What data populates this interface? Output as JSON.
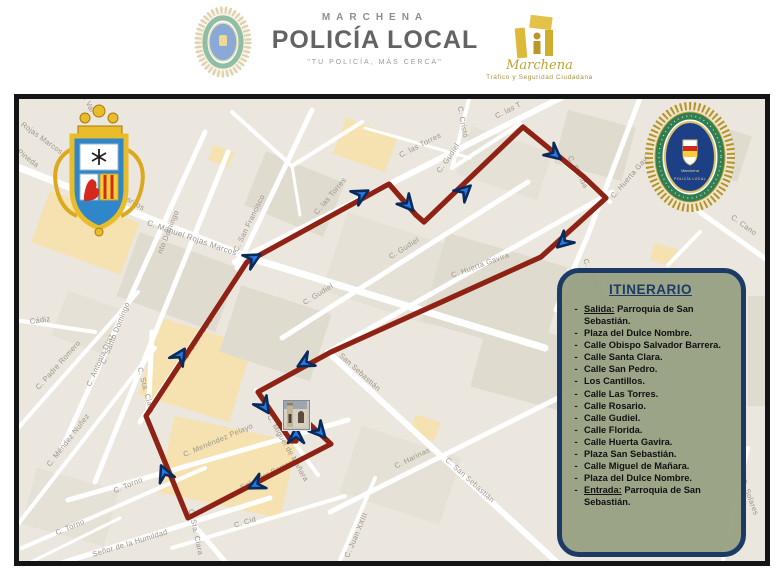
{
  "header": {
    "brand_top": "MARCHENA",
    "brand_main": "POLICÍA LOCAL",
    "brand_tagline": "\"TU POLICÍA, MÁS CERCA\"",
    "right_logo_script": "Marchena",
    "right_logo_sub": "Tráfico y Seguridad Ciudadana"
  },
  "itinerary": {
    "title": "ITINERARIO",
    "items": [
      {
        "prefix": "Salida:",
        "text": "Parroquia de San Sebastián."
      },
      {
        "text": "Plaza del Dulce Nombre."
      },
      {
        "text": "Calle Obispo Salvador Barrera."
      },
      {
        "text": "Calle Santa Clara."
      },
      {
        "text": "Calle San Pedro."
      },
      {
        "text": "Los Cantillos."
      },
      {
        "text": "Calle Las Torres."
      },
      {
        "text": "Calle Rosario."
      },
      {
        "text": "Calle Gudiel."
      },
      {
        "text": "Calle Florida."
      },
      {
        "text": "Calle Huerta Gavira."
      },
      {
        "text": "Plaza San Sebastián."
      },
      {
        "text": "Calle Miguel de Mañara."
      },
      {
        "text": "Plaza del Dulce Nombre."
      },
      {
        "prefix": "Entrada:",
        "text": "Parroquia de San Sebastián."
      }
    ]
  },
  "map": {
    "badge": {
      "top": "Marchena",
      "bottom": "POLICÍA LOCAL"
    },
    "route": {
      "color": "#8e2315",
      "width": 5.2,
      "points": "305,420 331,444 188,518 146,416 247,262 389,184 416,215 424,222 523,127 584,177 606,198 541,257 331,352 258,392 291,441 296,441 296,426"
    },
    "arrow": {
      "fill": "#2878e0",
      "stroke": "#0a2a5c"
    },
    "arrows": [
      {
        "x": 322,
        "y": 434,
        "r": 48
      },
      {
        "x": 253,
        "y": 486,
        "r": 153
      },
      {
        "x": 163,
        "y": 470,
        "r": -113
      },
      {
        "x": 182,
        "y": 353,
        "r": -57
      },
      {
        "x": 256,
        "y": 257,
        "r": -29
      },
      {
        "x": 364,
        "y": 193,
        "r": -29
      },
      {
        "x": 410,
        "y": 207,
        "r": 49
      },
      {
        "x": 467,
        "y": 189,
        "r": -43
      },
      {
        "x": 557,
        "y": 156,
        "r": 40
      },
      {
        "x": 561,
        "y": 244,
        "r": 138
      },
      {
        "x": 302,
        "y": 364,
        "r": 151
      },
      {
        "x": 266,
        "y": 409,
        "r": 56
      },
      {
        "x": 296,
        "y": 432,
        "r": -90
      }
    ],
    "street_labels": [
      {
        "t": "Rojas Marcos",
        "x": 42,
        "y": 138,
        "r": 36
      },
      {
        "t": "C. Pineda",
        "x": 24,
        "y": 155,
        "r": 38
      },
      {
        "t": "C. Val",
        "x": 88,
        "y": 102,
        "r": 65
      },
      {
        "t": "as Marcos",
        "x": 128,
        "y": 199,
        "r": 30
      },
      {
        "t": "C. Manuel Rojas Marcos",
        "x": 192,
        "y": 238,
        "r": 19,
        "s": 8
      },
      {
        "t": "C. San Francisco",
        "x": 249,
        "y": 223,
        "r": -64
      },
      {
        "t": "C. Cristó",
        "x": 463,
        "y": 122,
        "r": 80
      },
      {
        "t": "C. las Torres",
        "x": 420,
        "y": 145,
        "r": -27
      },
      {
        "t": "C. las Torres",
        "x": 330,
        "y": 196,
        "r": -50
      },
      {
        "t": "C. las T",
        "x": 508,
        "y": 110,
        "r": -27
      },
      {
        "t": "C. Gudiel",
        "x": 318,
        "y": 294,
        "r": -32
      },
      {
        "t": "C. Gudiel",
        "x": 404,
        "y": 248,
        "r": -32
      },
      {
        "t": "C. Gudiel",
        "x": 448,
        "y": 158,
        "r": -55
      },
      {
        "t": "C. Santo Domingo",
        "x": 115,
        "y": 333,
        "r": -68
      },
      {
        "t": "nto Domingo",
        "x": 168,
        "y": 232,
        "r": -68
      },
      {
        "t": "C. Antonia Díaz",
        "x": 100,
        "y": 360,
        "r": -66
      },
      {
        "t": "Cádiz",
        "x": 40,
        "y": 320,
        "r": -8
      },
      {
        "t": "C. Padre Romero",
        "x": 58,
        "y": 365,
        "r": -48
      },
      {
        "t": "C. Méndez Nuñez",
        "x": 68,
        "y": 440,
        "r": -52
      },
      {
        "t": "C. Torno",
        "x": 128,
        "y": 485,
        "r": -23
      },
      {
        "t": "C. Torno",
        "x": 70,
        "y": 527,
        "r": -23
      },
      {
        "t": "Señor de la Humildad",
        "x": 130,
        "y": 543,
        "r": -17
      },
      {
        "t": "C. Sta. Clara",
        "x": 146,
        "y": 390,
        "r": 75
      },
      {
        "t": "C. Sta. Clara",
        "x": 196,
        "y": 532,
        "r": 78
      },
      {
        "t": "C. Menéndez Pelayo",
        "x": 218,
        "y": 440,
        "r": -23
      },
      {
        "t": "C. San Pedro",
        "x": 198,
        "y": 338,
        "r": -57
      },
      {
        "t": "Salvador Barrera",
        "x": 268,
        "y": 474,
        "r": -27
      },
      {
        "t": "C. Miguel de Mañara",
        "x": 288,
        "y": 448,
        "r": 60
      },
      {
        "t": "San Sebastián",
        "x": 360,
        "y": 372,
        "r": 42
      },
      {
        "t": "C. San Sebastián",
        "x": 470,
        "y": 480,
        "r": 42
      },
      {
        "t": "C. Harinas",
        "x": 412,
        "y": 458,
        "r": -26
      },
      {
        "t": "C. Juan XXIII",
        "x": 356,
        "y": 535,
        "r": -67
      },
      {
        "t": "C. Cid",
        "x": 245,
        "y": 522,
        "r": -17
      },
      {
        "t": "C. Florida",
        "x": 578,
        "y": 172,
        "r": 62
      },
      {
        "t": "C. Huerta Gavira",
        "x": 632,
        "y": 174,
        "r": -49
      },
      {
        "t": "C. Huerta Gavira",
        "x": 480,
        "y": 265,
        "r": -20
      },
      {
        "t": "C. Cantareros",
        "x": 596,
        "y": 282,
        "r": 65
      },
      {
        "t": "C. Cano",
        "x": 744,
        "y": 225,
        "r": 36
      },
      {
        "t": "C. Solares",
        "x": 750,
        "y": 497,
        "r": 70
      }
    ]
  }
}
